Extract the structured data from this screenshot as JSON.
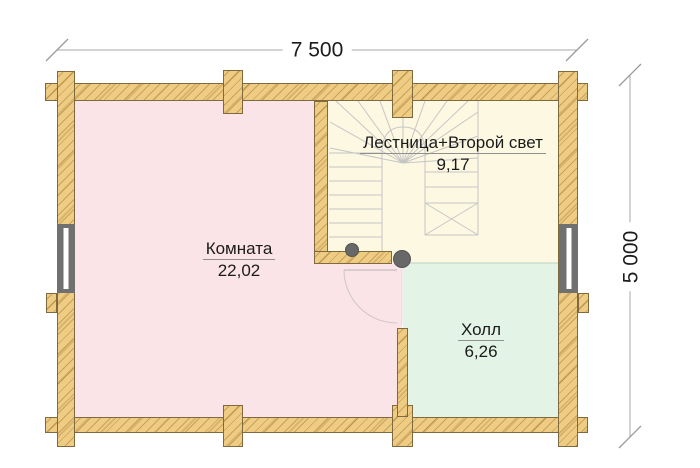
{
  "plan": {
    "rooms": [
      {
        "name": "Комната",
        "area": "22,02"
      },
      {
        "name": "Лестница+Второй свет",
        "area": "9,17"
      },
      {
        "name": "Холл",
        "area": "6,26"
      }
    ],
    "dimensions": {
      "width": "7 500",
      "height": "5 000"
    }
  },
  "colors": {
    "wood": "#eecc84",
    "room_pink": "#fbe4e7",
    "room_cream": "#fcf8e1",
    "room_green": "#e3f3e6",
    "post": "#686868",
    "window": "#707070",
    "stair_line": "#c6c6c6",
    "door_line": "#cfc6c6",
    "dim_line": "#a8a8a8",
    "text": "#1b1b1b"
  }
}
